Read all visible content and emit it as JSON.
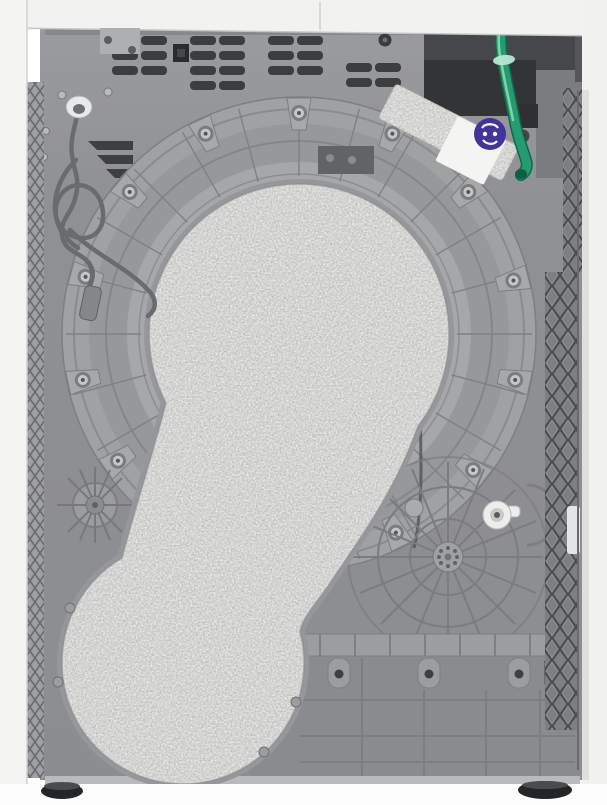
{
  "figure": {
    "alt": "Rear view of a white freestanding tumble dryer with its grey back panel exposed: a large round drum housing is covered by a keyhole-shaped speckled foam insulation pad, a coiled grey power cord hangs on the left, a green condensate drain hose with a white connector runs down the top right past a purple round sticker on a white label, ventilation slots line the top edge and black adjustable feet support the plastic base."
  },
  "colors": {
    "white_body": "#f2f2f1",
    "panel_grey": "#8f9093",
    "drum_outer": "#a0a1a3",
    "drum_band": "#97989a",
    "drum_inner": "#a6a7a9",
    "foam_base": "#d7d7d5",
    "foam_rim": "#96979a",
    "vent_dark": "#3c3d3f",
    "recess_dark": "#46474a",
    "recess_darker": "#333436",
    "block_grey": "#7b7c7f",
    "lattice_grey": "#7e7f82",
    "lattice_dark": "#4b4c4e",
    "cord_grey": "#6a6b6e",
    "hose_green": "#259b72",
    "hose_outline": "#10684a",
    "hose_highlight": "#8ed7b4",
    "clamp_green": "#b9e6d2",
    "sticker_purple": "#43339d",
    "label_white": "#f4f4f2",
    "foot_black": "#242526",
    "base_shade": "#8a8b8e"
  },
  "parts": {
    "top_panel": "white top panel",
    "back_panel": "grey rear panel",
    "vent_slots": "ventilation slots",
    "power_cord": "coiled power cord",
    "cable_grommet": "cable grommet",
    "drum_housing": "drum housing",
    "insulation_pad": "keyhole-shaped foam insulation pad",
    "foam_strip": "diagonal foam strip",
    "warning_sticker": "round purple sticker",
    "drain_hose": "green drain hose",
    "hose_connector": "white hose connector",
    "hose_clamp": "hose clamp ring",
    "service_recess": "dark service recess",
    "side_trim_left": "left side trim strip",
    "side_trim_right": "right lattice trim strip",
    "base_molding": "plastic base molding",
    "fan_hub": "spoked fan hub",
    "idler_wheel": "small spoked wheel",
    "pulley_keeper": "white pulley keeper",
    "leveling_feet": "black leveling feet"
  }
}
